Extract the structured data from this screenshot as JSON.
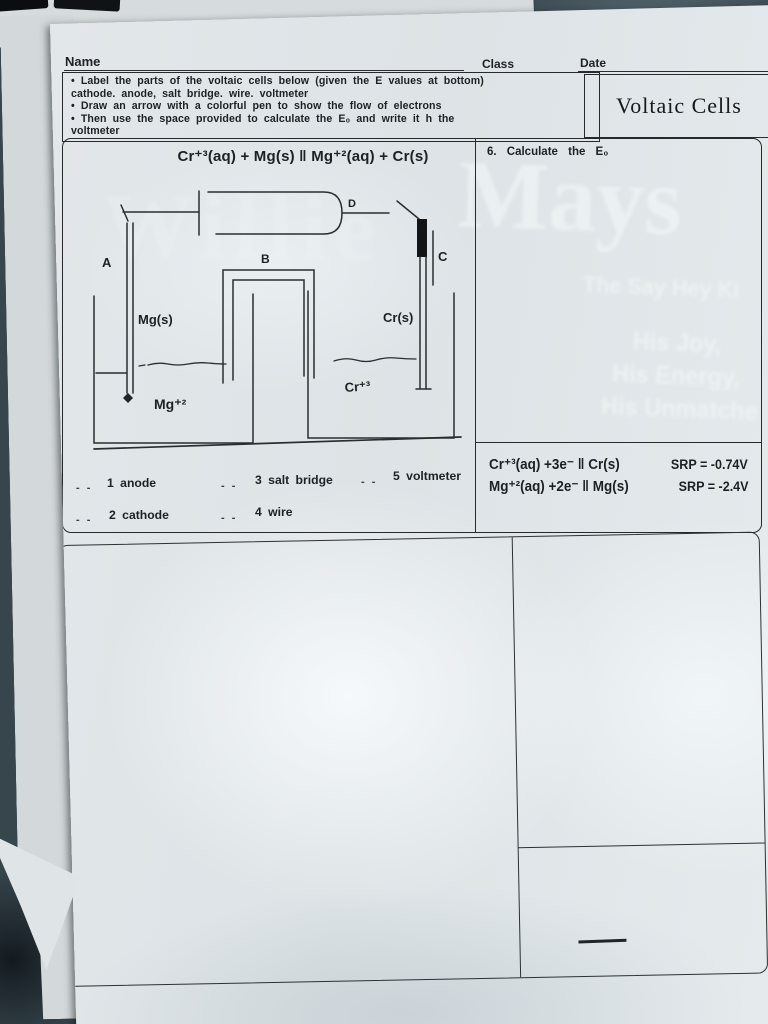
{
  "header": {
    "name_label": "Name",
    "class_label": "Class",
    "date_label": "Date"
  },
  "instructions": {
    "lines": [
      "• Label the parts of the voltaic cells below  (given the E values at bottom)",
      "cathode. anode, salt bridge. wire. voltmeter",
      "• Draw an arrow with a colorful pen to show the flow of electrons",
      "• Then use the space provided to calculate the E₀ and write it h the",
      "voltmeter"
    ],
    "title": "Voltaic Cells"
  },
  "problem1": {
    "equation": "Cr⁺³(aq) + Mg(s) ‖ Mg⁺²(aq) + Cr(s)",
    "question": "6.  Calculate  the  E₀",
    "diagram": {
      "label_a": "A",
      "label_b": "B",
      "label_c": "C",
      "label_d": "D",
      "left_electrode": "Mg(s)",
      "right_electrode": "Cr(s)",
      "left_solution": "Mg⁺²",
      "right_solution": "Cr⁺³"
    },
    "word_bank": [
      "1  anode",
      "2 cathode",
      "3  salt bridge",
      "4  wire",
      "5  voltmeter"
    ],
    "blank_mark": "- -",
    "half_reactions": [
      {
        "eq": "Cr⁺³(aq) +3e⁻  ‖ Cr(s)",
        "srp": "SRP = -0.74V"
      },
      {
        "eq": "Mg⁺²(aq) +2e⁻  ‖ Mg(s)",
        "srp": "SRP = -2.4V"
      }
    ]
  },
  "watermarks": {
    "mays": "Mays",
    "willie": "Willie",
    "tagline1": "The Say Hey Ki",
    "tagline2": "His Joy,",
    "tagline3": "His Energy,",
    "tagline4": "His Unmatche"
  },
  "colors": {
    "paper": "#e2e7ea",
    "background": "#37454d",
    "ink": "#1e2124",
    "watermark": "#f3f8fa"
  }
}
